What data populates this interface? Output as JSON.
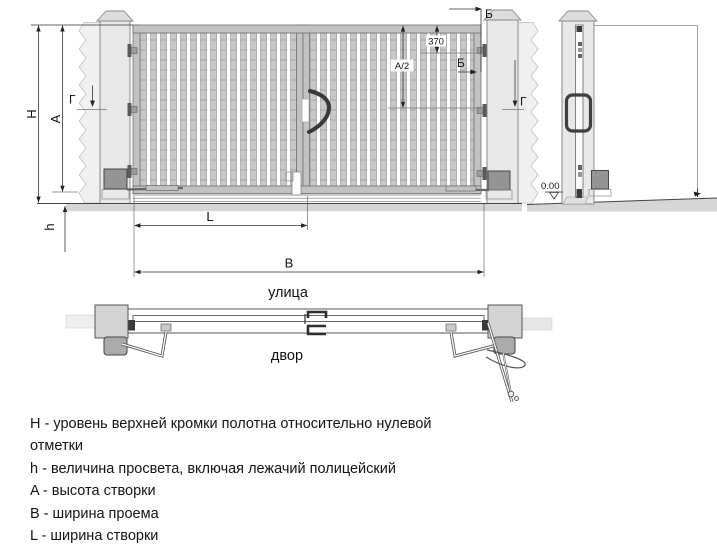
{
  "labels": {
    "dim_top_level": "H",
    "dim_leaf_height": "A",
    "dim_gap": "h",
    "dim_leaf_width": "L",
    "dim_opening_width": "B",
    "dim_370": "370",
    "dim_half_height": "A/2",
    "section_b_top": "Б",
    "section_b_mid": "Б",
    "section_g_left": "Г",
    "section_g_right": "Г",
    "level_zero": "0.00",
    "street": "улица",
    "yard": "двор"
  },
  "legend": {
    "lines": [
      "H - уровень верхней кромки полотна относительно нулевой",
      "отметки",
      "h - величина просвета, включая лежачий полицейский",
      "A - высота створки",
      "B - ширина проема",
      "L - ширина створки"
    ]
  },
  "colors": {
    "bar_fill": "#c7c7c7",
    "frame_fill": "#c2c2c2",
    "post_fill": "#e8e8e8",
    "ground_fill": "#d6d6d6",
    "motor_fill": "#949494",
    "dark_accent": "#3a3a3a",
    "dim_line": "#333333"
  }
}
